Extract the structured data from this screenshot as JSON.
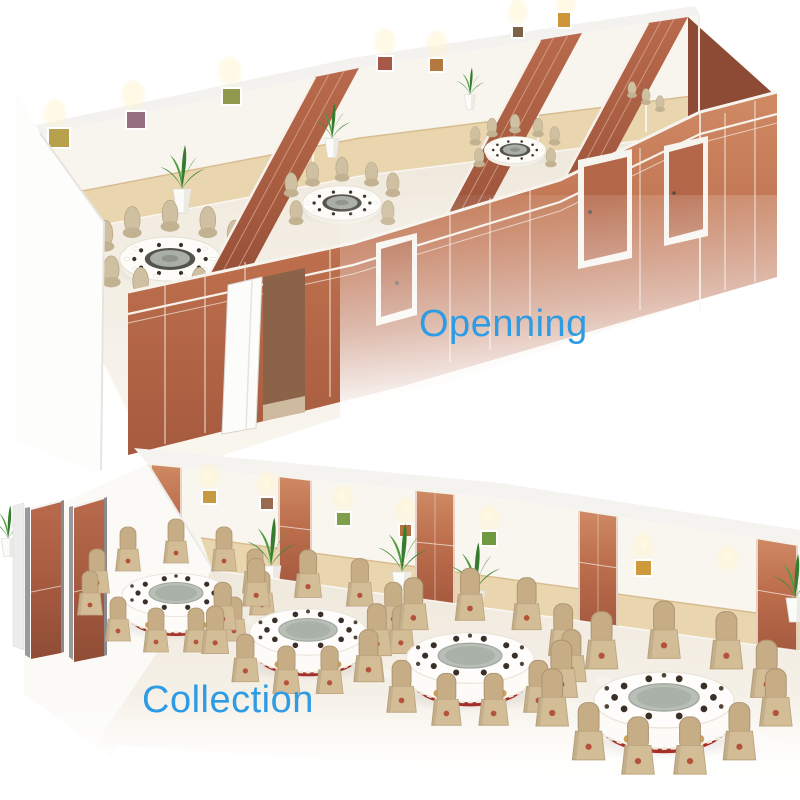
{
  "captions": {
    "top": "Openning",
    "bottom": "Collection"
  },
  "colors": {
    "caption_blue": "#2E9BE5",
    "partition_wood": "#BD6F4D",
    "partition_wood_dark": "#A05840",
    "wainscot_tan": "#E9D6AF",
    "wall_white": "#F8F5EF",
    "floor_beige": "#F0E9DF",
    "chair_beige": "#C6AD85",
    "tablecloth_white": "#FCFBF7",
    "table_skirt_red": "#A5302A",
    "lazy_susan_gray": "#B9BFB6",
    "plant_green": "#3E8A36",
    "trim_white": "#F6F2EA"
  }
}
